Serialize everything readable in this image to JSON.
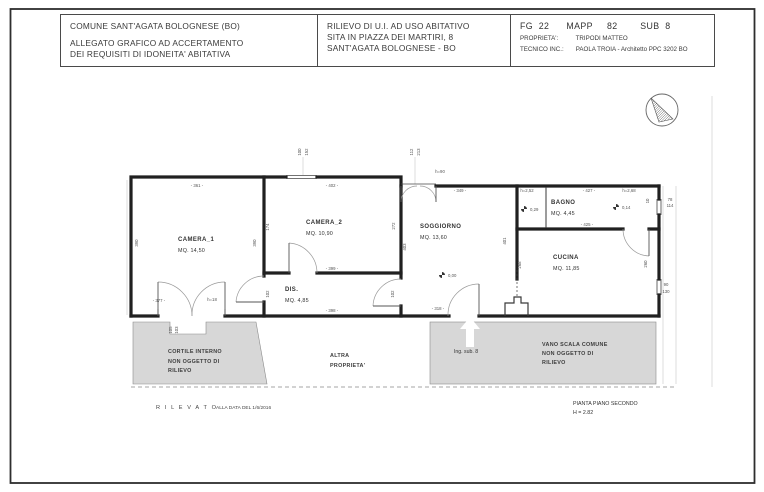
{
  "header": {
    "col1": [
      "COMUNE SANT'AGATA BOLOGNESE  (BO)",
      "ALLEGATO GRAFICO AD ACCERTAMENTO",
      "DEI REQUISITI DI IDONEITA' ABITATIVA"
    ],
    "col2": [
      "RILIEVO DI U.I. AD USO ABITATIVO",
      "SITA IN PIAZZA DEI MARTIRI, 8",
      "SANT'AGATA BOLOGNESE - BO"
    ],
    "col3": {
      "ref": "FG  22      MAPP     82        SUB  8",
      "prop_label": "PROPRIETA':",
      "prop_value": "TRIPODI MATTEO",
      "tech_label": "TECNICO INC.:",
      "tech_value": "PAOLA TROIA - Architetto PPC 3202 BO"
    }
  },
  "plan": {
    "rooms": [
      {
        "name": "CAMERA_1",
        "area": "MQ. 14,50",
        "x": 178,
        "y": 241
      },
      {
        "name": "CAMERA_2",
        "area": "MQ. 10,90",
        "x": 306,
        "y": 224
      },
      {
        "name": "DIS.",
        "area": "MQ. 4,85",
        "x": 285,
        "y": 291
      },
      {
        "name": "SOGGIORNO",
        "area": "MQ. 13,60",
        "x": 420,
        "y": 228
      },
      {
        "name": "BAGNO",
        "area": "MQ. 4,45",
        "x": 551,
        "y": 204
      },
      {
        "name": "CUCINA",
        "area": "MQ. 11,85",
        "x": 553,
        "y": 259
      }
    ],
    "zones": [
      {
        "line1": "CORTILE INTERNO",
        "line2": "NON OGGETTO DI",
        "line3": "RILIEVO"
      },
      {
        "line1": "ALTRA",
        "line2": "PROPRIETA'",
        "line3": ""
      },
      {
        "line1": "VANO SCALA COMUNE",
        "line2": "NON OGGETTO DI",
        "line3": "RILIEVO"
      }
    ],
    "entry_label": "Ing. sub. 8",
    "levels": [
      {
        "v": "0,29",
        "x": 524,
        "y": 209
      },
      {
        "v": "0,14",
        "x": 616,
        "y": 207
      },
      {
        "v": "0,00",
        "x": 442,
        "y": 275
      }
    ],
    "dim_labels": [
      {
        "t": "- 361 -",
        "x": 197,
        "y": 187
      },
      {
        "t": "- 402 -",
        "x": 332,
        "y": 187
      },
      {
        "t": "- 349 -",
        "x": 460,
        "y": 192
      },
      {
        "t": "h=90",
        "x": 440,
        "y": 173
      },
      {
        "t": "h=2,52",
        "x": 527,
        "y": 192
      },
      {
        "t": "- 427 -",
        "x": 589,
        "y": 192
      },
      {
        "t": "h=2,68",
        "x": 629,
        "y": 192
      },
      {
        "t": "- 425 -",
        "x": 587,
        "y": 226
      },
      {
        "t": "- 399 -",
        "x": 332,
        "y": 270
      },
      {
        "t": "- 398 -",
        "x": 332,
        "y": 312
      },
      {
        "t": "- 377 -",
        "x": 159,
        "y": 302
      },
      {
        "t": "h=18",
        "x": 212,
        "y": 301
      },
      {
        "t": "- 318 -",
        "x": 438,
        "y": 310
      },
      {
        "t": "390",
        "x": 138,
        "y": 243,
        "r": -90
      },
      {
        "t": "390",
        "x": 256,
        "y": 243,
        "r": -90
      },
      {
        "t": "174",
        "x": 269,
        "y": 227,
        "r": -90
      },
      {
        "t": "272",
        "x": 395,
        "y": 226,
        "r": -90
      },
      {
        "t": "403",
        "x": 406,
        "y": 247,
        "r": -90
      },
      {
        "t": "401",
        "x": 506,
        "y": 241,
        "r": -90
      },
      {
        "t": "268",
        "x": 521,
        "y": 265,
        "r": -90
      },
      {
        "t": "260",
        "x": 647,
        "y": 264,
        "r": -90
      },
      {
        "t": "102",
        "x": 269,
        "y": 294,
        "r": -90
      },
      {
        "t": "102",
        "x": 394,
        "y": 294,
        "r": -90
      },
      {
        "t": "10",
        "x": 649,
        "y": 201,
        "r": -90
      },
      {
        "t": "78",
        "x": 670,
        "y": 201
      },
      {
        "t": "114",
        "x": 670,
        "y": 207
      },
      {
        "t": "90",
        "x": 666,
        "y": 286
      },
      {
        "t": "130",
        "x": 666,
        "y": 293
      },
      {
        "t": "100",
        "x": 301,
        "y": 152,
        "r": -90
      },
      {
        "t": "152",
        "x": 308,
        "y": 152,
        "r": -90
      },
      {
        "t": "112",
        "x": 413,
        "y": 152,
        "r": -90
      },
      {
        "t": "213",
        "x": 420,
        "y": 152,
        "r": -90
      },
      {
        "t": "105",
        "x": 172,
        "y": 330,
        "r": -90
      },
      {
        "t": "103",
        "x": 178,
        "y": 330,
        "r": -90
      }
    ]
  },
  "footer": {
    "surveyed_word": "R I L E V A T O",
    "surveyed_date": "ALLA DATA DEL 1/6/2016",
    "plan_title": "PIANTA PIANO SECONDO",
    "plan_height": "H = 2.82"
  },
  "colors": {
    "zone_fill": "#d7d7d7",
    "wall": "#202020",
    "thin_line": "#8a8a8a"
  }
}
